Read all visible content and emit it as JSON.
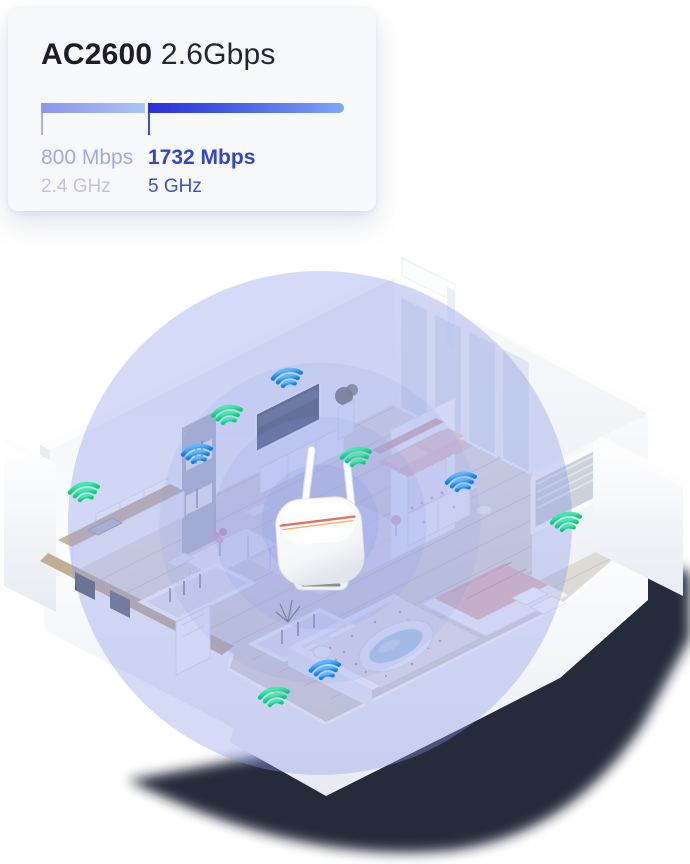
{
  "card": {
    "title_bold": "AC2600",
    "title_rest": "2.6Gbps",
    "bands": [
      {
        "speed": "800 Mbps",
        "freq": "2.4 GHz",
        "bar_color_start": "#8d95e8",
        "bar_color_end": "#abc3f8",
        "speed_color": "#a2abdf",
        "freq_color": "#c0c6d8"
      },
      {
        "speed": "1732 Mbps",
        "freq": "5 GHz",
        "bar_color_start": "#2a2fd8",
        "bar_color_end": "#7ea7f6",
        "speed_color": "#3245cf",
        "freq_color": "#3b4ed6"
      }
    ]
  },
  "scene": {
    "description": "isometric-apartment-wifi-coverage",
    "coverage_color": "#8b98e9",
    "signal_colors": {
      "green": "#18d68c",
      "blue": "#2b9cf3"
    },
    "wifi_points": [
      {
        "color": "blue",
        "x": 288,
        "y": 381
      },
      {
        "color": "green",
        "x": 228,
        "y": 418
      },
      {
        "color": "blue",
        "x": 198,
        "y": 457
      },
      {
        "color": "green",
        "x": 85,
        "y": 495
      },
      {
        "color": "green",
        "x": 357,
        "y": 460
      },
      {
        "color": "blue",
        "x": 462,
        "y": 485
      },
      {
        "color": "green",
        "x": 567,
        "y": 525
      },
      {
        "color": "blue",
        "x": 326,
        "y": 673
      },
      {
        "color": "green",
        "x": 275,
        "y": 700
      }
    ]
  }
}
